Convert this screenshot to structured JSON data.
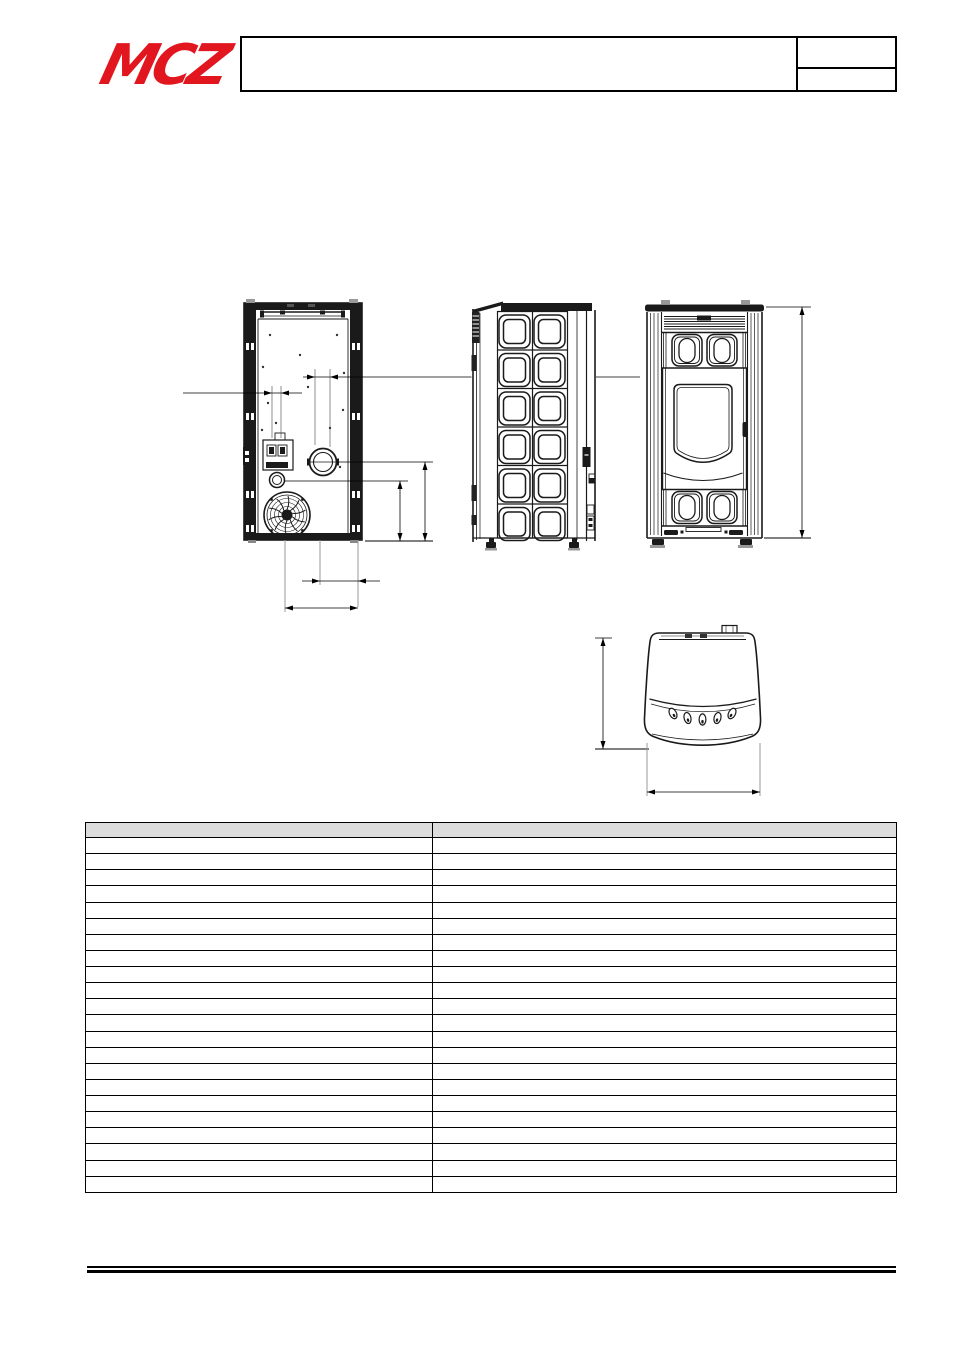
{
  "header": {
    "logo_text": "MCZ",
    "title": "",
    "info_box": {
      "top": "",
      "bottom": ""
    }
  },
  "colors": {
    "logo_red": "#E2161E",
    "drawing_line": "#1a1a1a",
    "extension_gray": "#9a9a9a",
    "table_header_bg": "#dcdcdc",
    "table_border": "#000000"
  },
  "drawings": {
    "views": [
      {
        "id": "rear-view"
      },
      {
        "id": "side-view"
      },
      {
        "id": "front-view"
      },
      {
        "id": "top-view"
      }
    ]
  },
  "table": {
    "columns": [
      "",
      ""
    ],
    "rows": [
      [
        "",
        ""
      ],
      [
        "",
        ""
      ],
      [
        "",
        ""
      ],
      [
        "",
        ""
      ],
      [
        "",
        ""
      ],
      [
        "",
        ""
      ],
      [
        "",
        ""
      ],
      [
        "",
        ""
      ],
      [
        "",
        ""
      ],
      [
        "",
        ""
      ],
      [
        "",
        ""
      ],
      [
        "",
        ""
      ],
      [
        "",
        ""
      ],
      [
        "",
        ""
      ],
      [
        "",
        ""
      ],
      [
        "",
        ""
      ],
      [
        "",
        ""
      ],
      [
        "",
        ""
      ],
      [
        "",
        ""
      ],
      [
        "",
        ""
      ],
      [
        "",
        ""
      ],
      [
        "",
        ""
      ]
    ]
  }
}
